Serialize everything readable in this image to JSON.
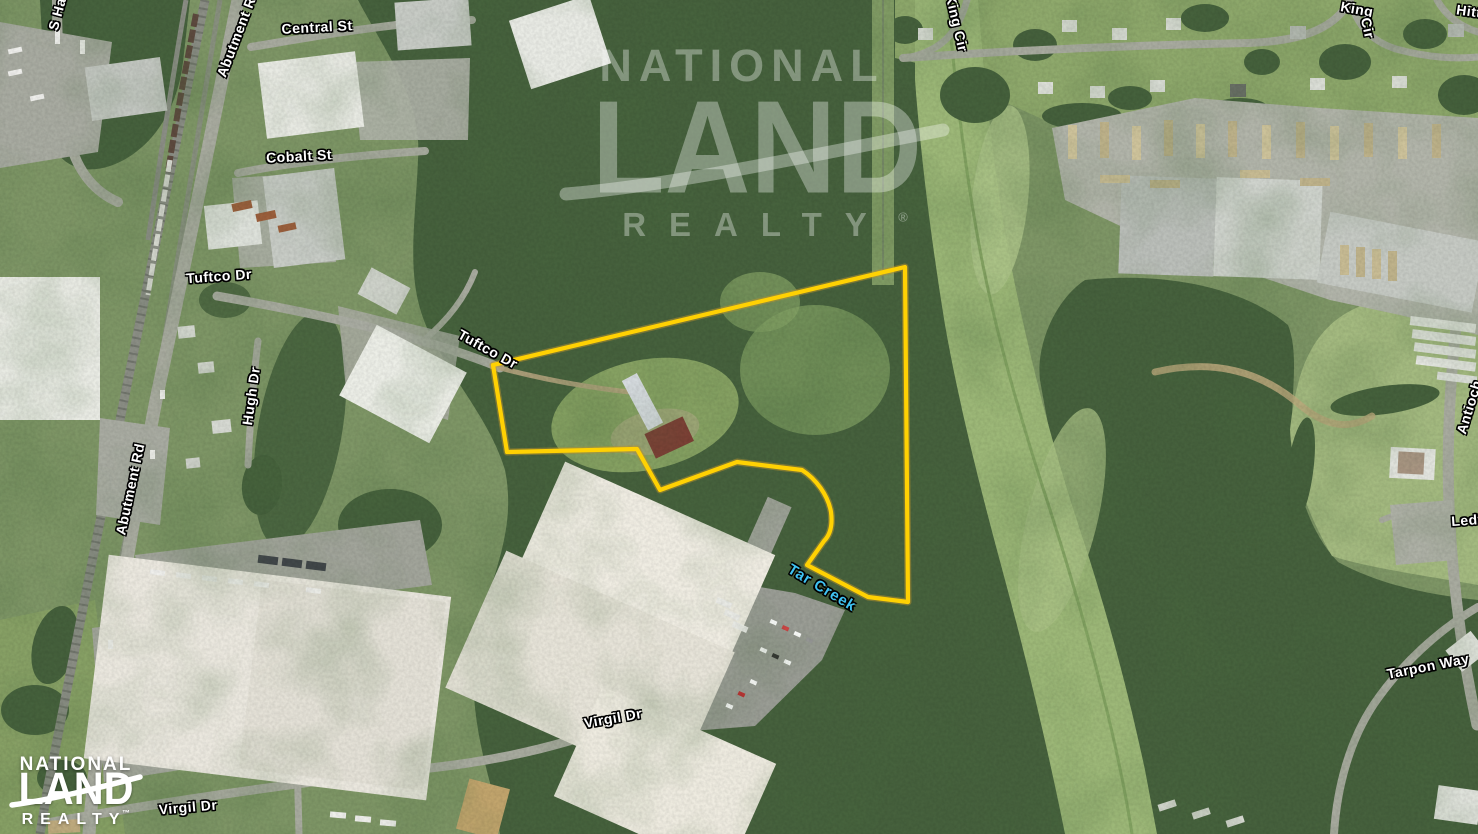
{
  "watermark": {
    "line1": "NATIONAL",
    "line2": "LAND",
    "line3": "REALTY",
    "registered": "®"
  },
  "logo": {
    "line1": "NATIONAL",
    "line2": "LAND",
    "line3": "REALTY",
    "trademark": "™"
  },
  "street_labels": [
    {
      "id": "s-hamilton",
      "text": "S Ha"
    },
    {
      "id": "abutment-rd-top",
      "text": "Abutment R"
    },
    {
      "id": "central-st",
      "text": "Central St"
    },
    {
      "id": "cobalt-st",
      "text": "Cobalt St"
    },
    {
      "id": "tuftco-dr-west",
      "text": "Tuftco Dr"
    },
    {
      "id": "tuftco-dr-east",
      "text": "Tuftco Dr"
    },
    {
      "id": "hugh-dr",
      "text": "Hugh Dr"
    },
    {
      "id": "abutment-rd",
      "text": "Abutment Rd"
    },
    {
      "id": "virgil-dr-center",
      "text": "Virgil Dr"
    },
    {
      "id": "virgil-dr-west",
      "text": "Virgil Dr"
    },
    {
      "id": "king-cir-west",
      "text": "King Cir"
    },
    {
      "id": "king-cir-east-1",
      "text": "King"
    },
    {
      "id": "king-cir-east-2",
      "text": "Cir"
    },
    {
      "id": "hitt",
      "text": "Hitt"
    },
    {
      "id": "antioch-rd",
      "text": "Antioch"
    },
    {
      "id": "ledford",
      "text": "Ledf"
    },
    {
      "id": "tarpon-way",
      "text": "Tarpon Way"
    }
  ],
  "water_labels": [
    {
      "id": "tar-creek",
      "text": "Tar Creek"
    }
  ],
  "colors": {
    "boundary": "#ffd103",
    "street_label": "#ffffff",
    "water_label": "#3fc2f2",
    "forest": "#46613d",
    "field": "#a4ba80",
    "road": "#a8ab9f"
  }
}
